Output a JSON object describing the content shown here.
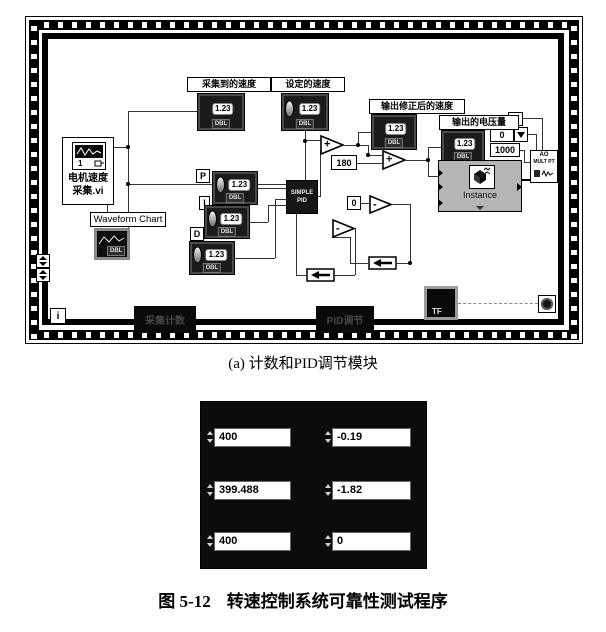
{
  "captions": {
    "sub": "(a) 计数和PID调节模块",
    "fig_no": "图 5-12",
    "fig_title": "转速控制系统可靠性测试程序"
  },
  "diagram": {
    "motor_vi": {
      "line1": "电机速度",
      "line2": "采集.vi",
      "digit": "1"
    },
    "waveform_chart": {
      "label": "Waveform Chart",
      "tag": "DBL"
    },
    "labels": {
      "collected": "采集到的速度",
      "set": "设定的速度",
      "corrected": "输出修正后的速度",
      "voltage": "输出的电压量"
    },
    "num_glyph": "1.23",
    "type_tag": "DBL",
    "pid": {
      "line1": "SIMPLE",
      "line2": "PID",
      "p": "P",
      "i": "I",
      "d": "D"
    },
    "constants": {
      "c180": "180",
      "c0": "0",
      "c1": "1",
      "ring": "0",
      "c1000": "1000"
    },
    "ops": {
      "plus": "+",
      "minus": "-"
    },
    "ao": {
      "line1": "AO",
      "line2": "MULT PT"
    },
    "instance_label": "Instance",
    "tf": "TF",
    "iteration": "i",
    "frame_labels": {
      "left": "采集计数",
      "right": "PID调节"
    }
  },
  "panel": {
    "rows": [
      {
        "left": "400",
        "right": "-0.19"
      },
      {
        "left": "399.488",
        "right": "-1.82"
      },
      {
        "left": "400",
        "right": "0"
      }
    ]
  },
  "colors": {
    "ink": "#000000",
    "panel_bg": "#0c0c0c",
    "express_gray": "#b5b5b5",
    "field_bg": "#ffffff"
  }
}
